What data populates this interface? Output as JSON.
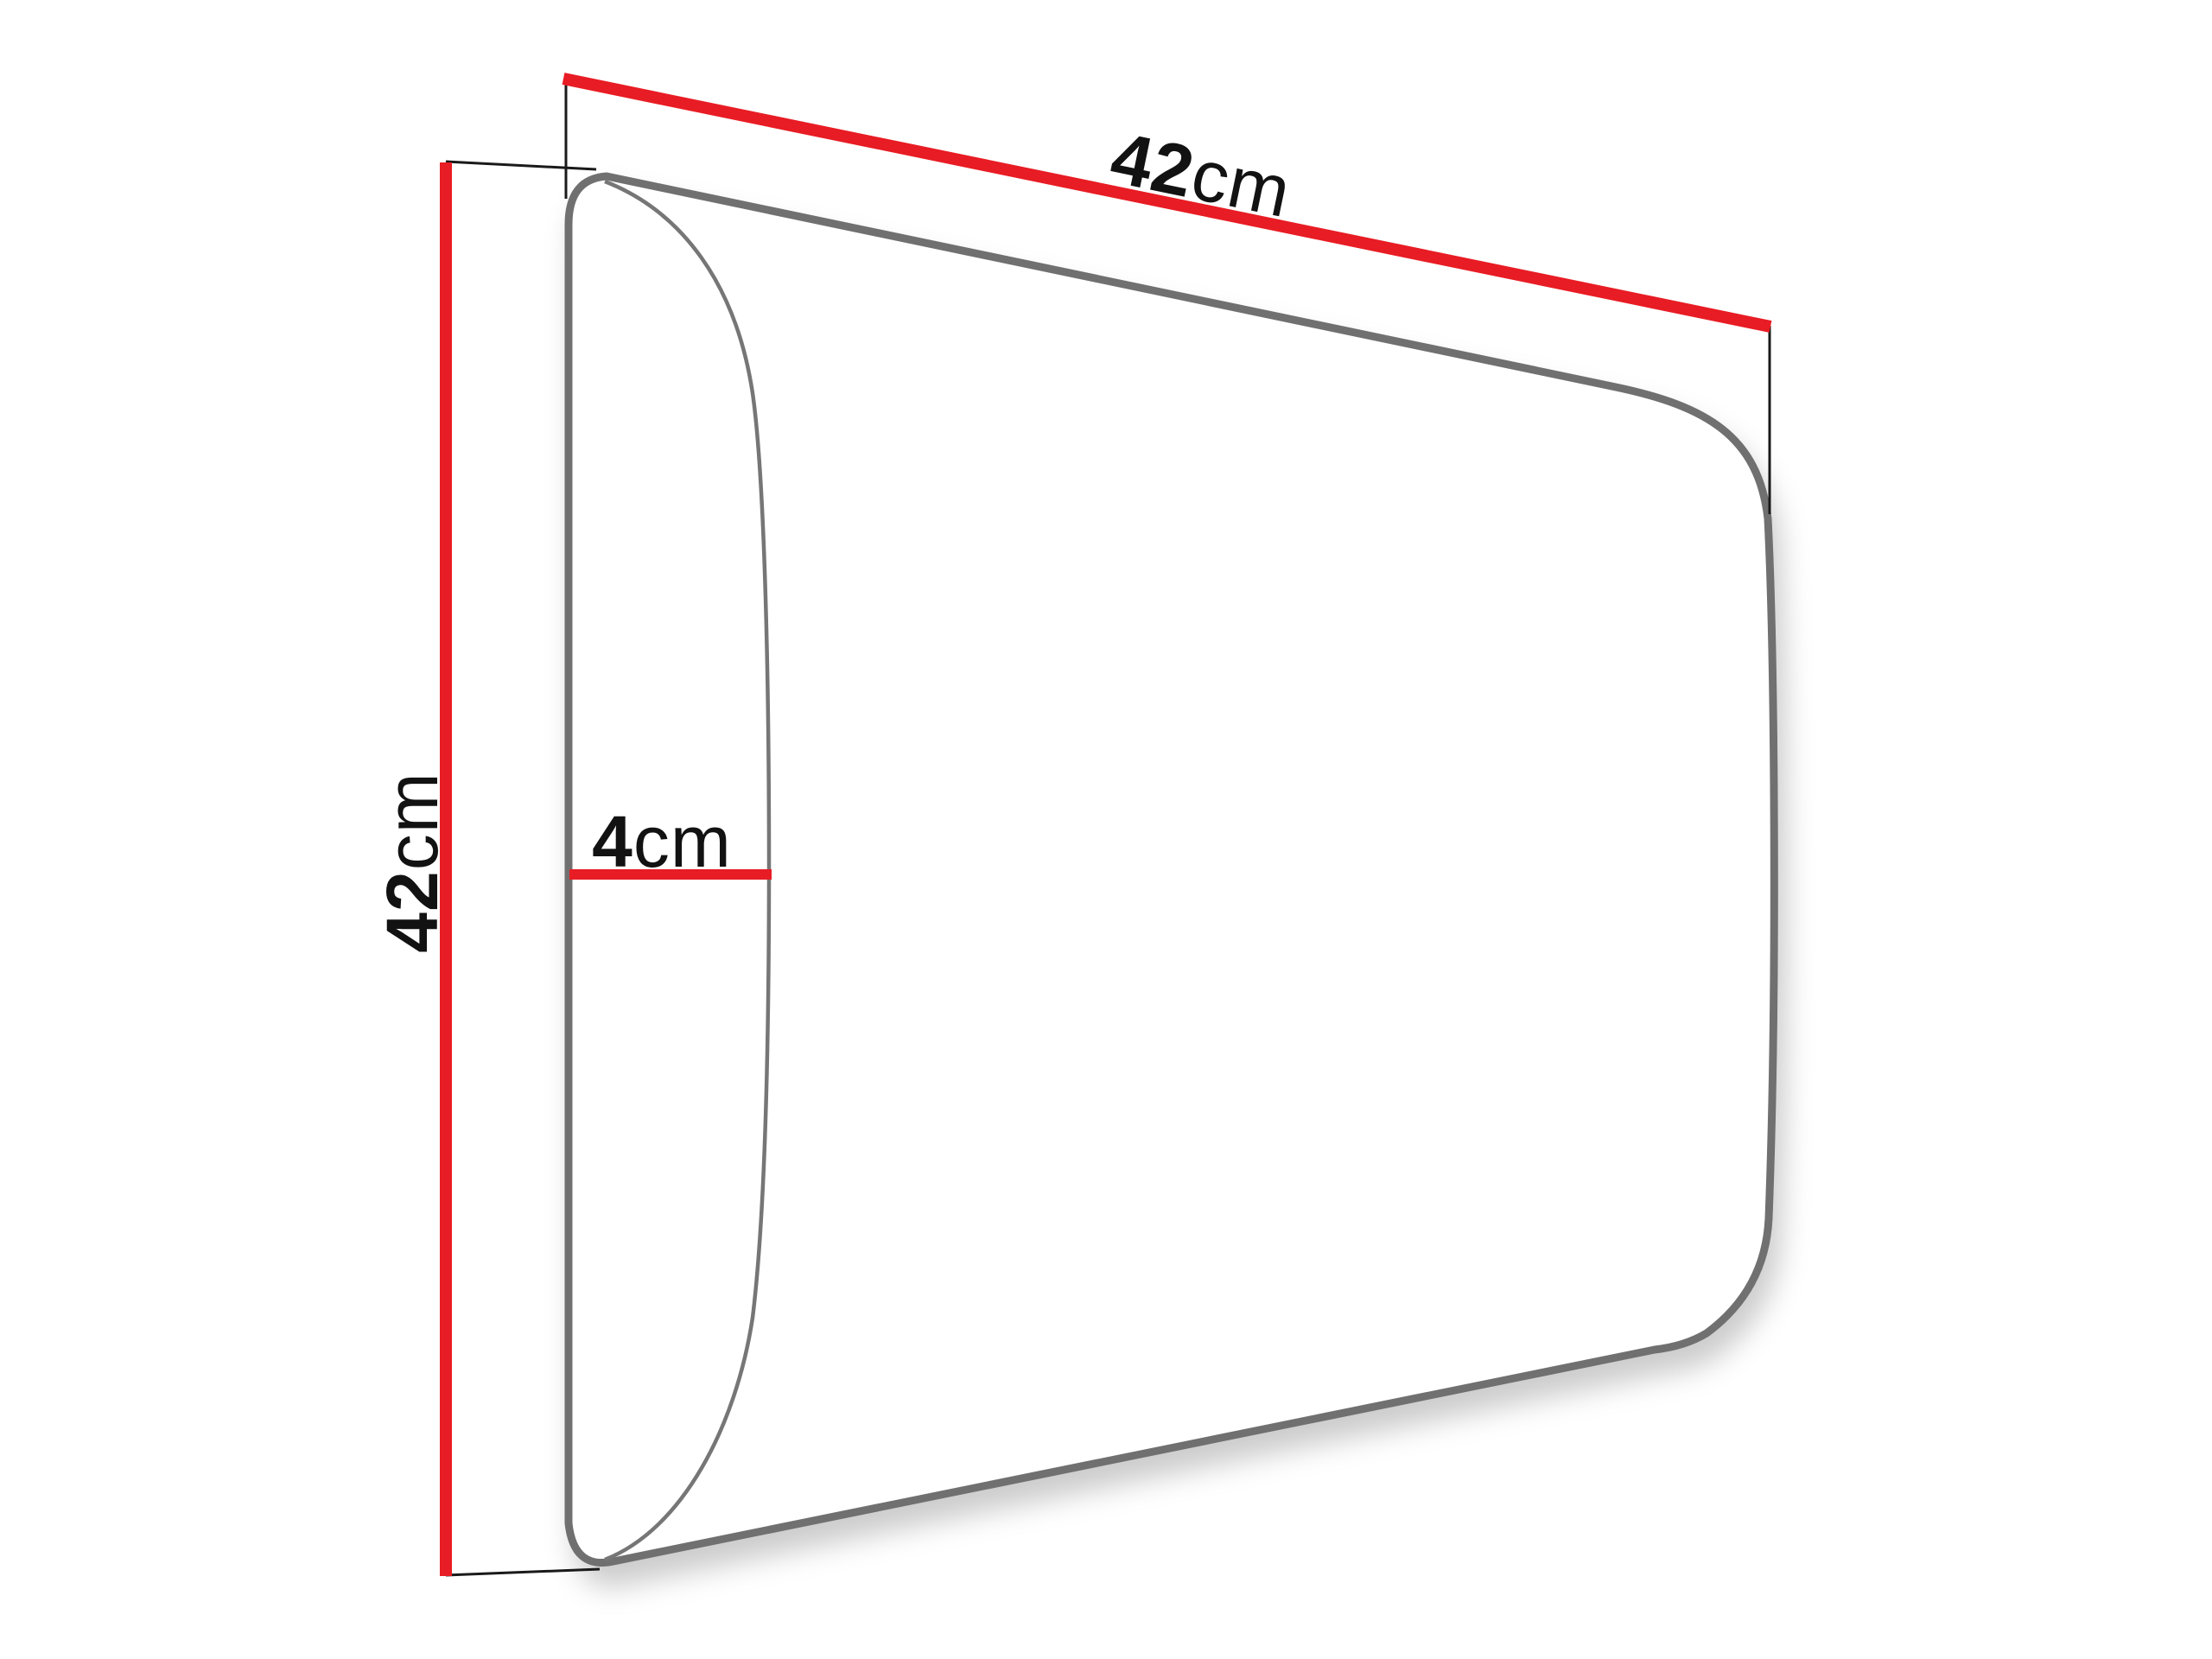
{
  "diagram": {
    "type": "dimension-drawing",
    "labels": {
      "width": {
        "value": "42",
        "unit": "cm"
      },
      "height": {
        "value": "42",
        "unit": "cm"
      },
      "depth": {
        "value": "4",
        "unit": "cm"
      }
    },
    "colors": {
      "dimension_line": "#E81C24",
      "panel_outline": "#707070",
      "front_curve": "#767676",
      "extension_line": "#1a1a1a",
      "label_text": "#121212",
      "background": "#ffffff"
    }
  }
}
